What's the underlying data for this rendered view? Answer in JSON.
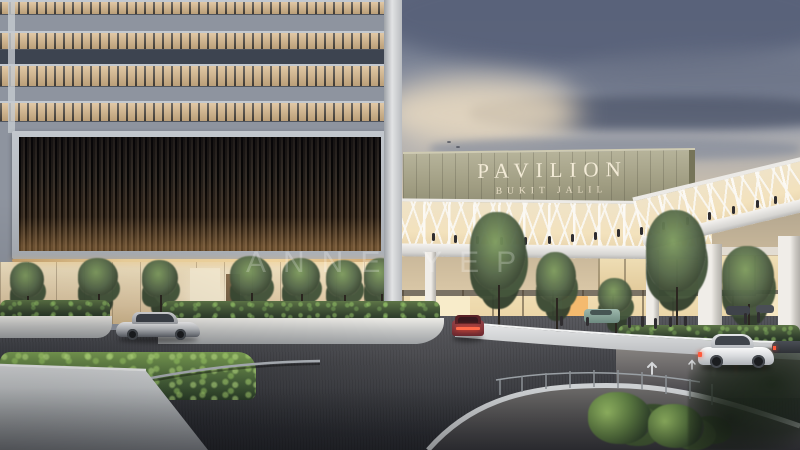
{
  "scene": {
    "type": "architectural rendering",
    "time_of_day": "dusk",
    "description": "Dusk exterior rendering of Pavilion Bukit Jalil: office tower with amber-lit window floors and a dark louvred screen wall on the left, sage-green signage facade, white truss pedestrian skybridge with shoppers, lit mall storefronts below, landscaped drop-off driveway with cars and white retaining walls"
  },
  "signage": {
    "title": "PAVILION",
    "subtitle": "BUKIT JALIL"
  },
  "watermark": {
    "text": "ANNE YEP"
  },
  "colors": {
    "sky_top": "#646e84",
    "sky_mid": "#9aa0ae",
    "sky_warm": "#ecdac1",
    "cloud_dark": "#59627a",
    "sign_panel": "#a09d82",
    "sign_text": "#f2ead6",
    "tower_window": "#d9b98c",
    "tower_spandrel": "#8e949f",
    "tower_dark_band": "#3d4450",
    "louver_dark": "#241f1a",
    "bridge_glow": "#f3e2bd",
    "road_dark": "#2a2c31",
    "hedge_green": "#34432f",
    "hedge_lit": "#7fa456",
    "wall_white": "#d6d8d9",
    "taillight_red": "#ff5a3c"
  }
}
